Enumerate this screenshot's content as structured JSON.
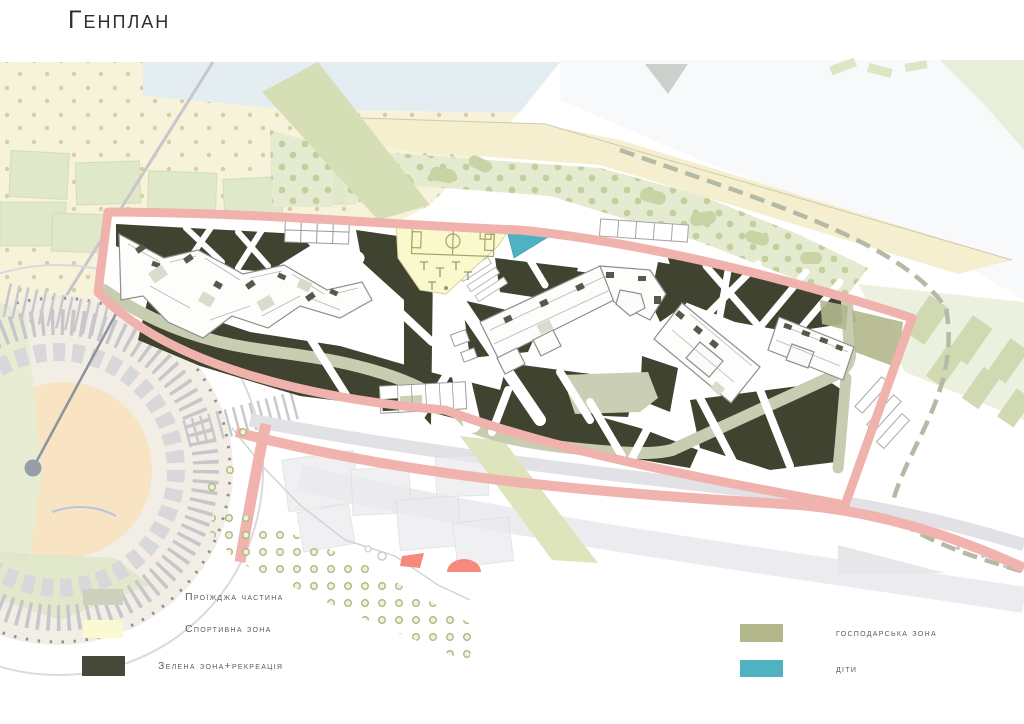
{
  "title": "Генплан",
  "legend": {
    "left": [
      {
        "label": "Проїжджа частина",
        "color": "#ccd0bd"
      },
      {
        "label": "Спортивна зона",
        "color": "#fbf9d2"
      },
      {
        "label": "Зелена зона+рекреація",
        "color": "#46493a"
      }
    ],
    "right": [
      {
        "label": "господарська зона",
        "color": "#b2b88c"
      },
      {
        "label": "діти",
        "color": "#50b1c1"
      }
    ]
  },
  "map": {
    "colors": {
      "site_boundary_pink": "#f0b2ac",
      "green_recreation_zone": "#3f4330",
      "roadway_olive": "#c8cdb2",
      "sport_zone_yellow": "#faf8cd",
      "children_zone_teal": "#50b1c2",
      "utility_zone_olive": "#b2b88c",
      "background_cream": "#f7f2db",
      "background_green": "#e3eacc",
      "water_blue": "#e4edf2",
      "context_grey": "#d9d9dc"
    }
  }
}
